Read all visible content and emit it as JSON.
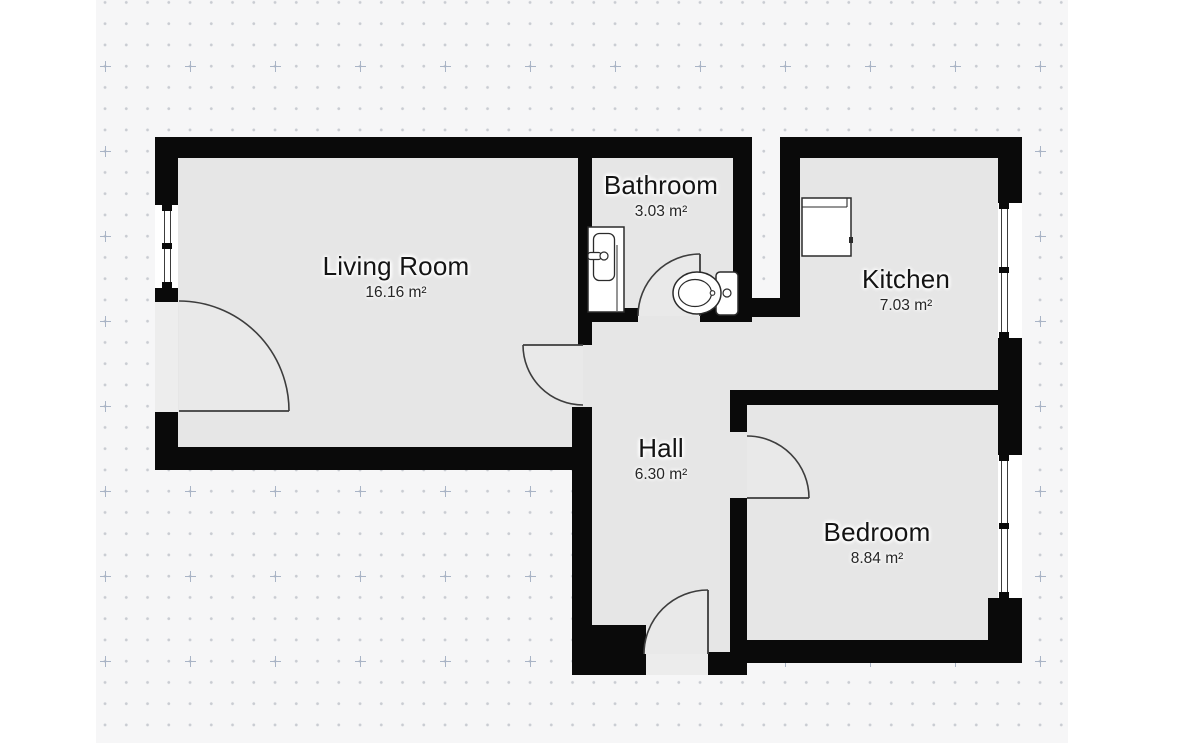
{
  "canvas": {
    "background_color": "#f6f6f7",
    "margin_color": "#ffffff",
    "dot_color": "#c9ccd2",
    "plus_mark_color": "#a9b4c6"
  },
  "plan": {
    "wall_color": "#0a0a0a",
    "floor_color": "#e6e6e6",
    "rooms": [
      {
        "id": "living-room",
        "name": "Living Room",
        "area": "16.16 m²"
      },
      {
        "id": "bathroom",
        "name": "Bathroom",
        "area": "3.03 m²"
      },
      {
        "id": "kitchen",
        "name": "Kitchen",
        "area": "7.03 m²"
      },
      {
        "id": "hall",
        "name": "Hall",
        "area": "6.30 m²"
      },
      {
        "id": "bedroom",
        "name": "Bedroom",
        "area": "8.84 m²"
      }
    ],
    "symbols": {
      "doors": 5,
      "windows": 3,
      "fixtures": [
        "sink",
        "toilet",
        "stove"
      ]
    }
  }
}
